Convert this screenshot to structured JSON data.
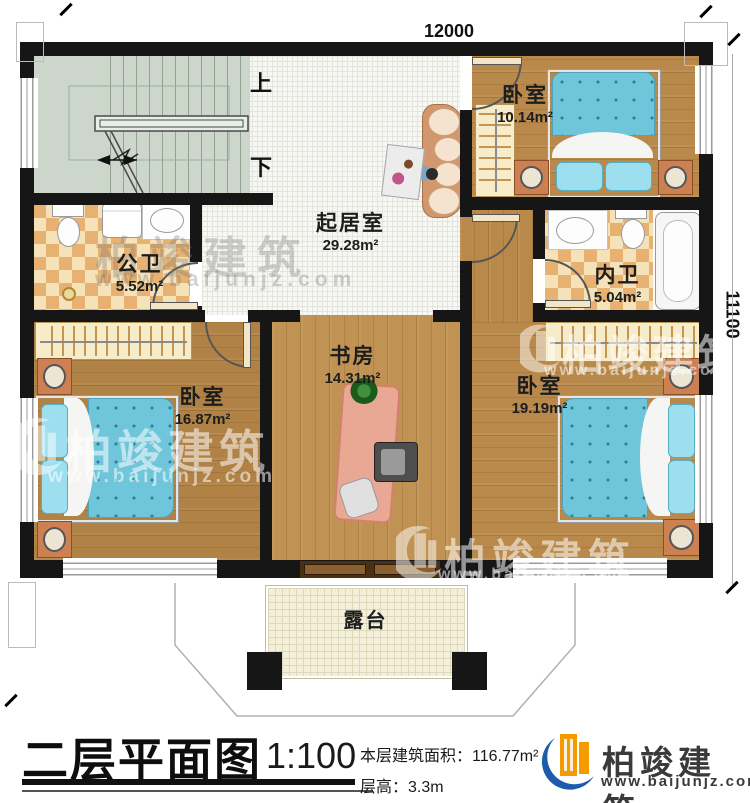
{
  "dimensions": {
    "top": "12000",
    "right": "11100"
  },
  "stairs": {
    "up": "上",
    "down": "下"
  },
  "rooms": {
    "bedroom_top": {
      "name": "卧室",
      "area": "10.14m²"
    },
    "living": {
      "name": "起居室",
      "area": "29.28m²"
    },
    "public_bath": {
      "name": "公卫",
      "area": "5.52m²"
    },
    "inner_bath": {
      "name": "内卫",
      "area": "5.04m²"
    },
    "bedroom_left": {
      "name": "卧室",
      "area": "16.87m²"
    },
    "study": {
      "name": "书房",
      "area": "14.31m²"
    },
    "bedroom_right": {
      "name": "卧室",
      "area": "19.19m²"
    },
    "terrace": {
      "name": "露台"
    }
  },
  "title_block": {
    "title": "二层平面图",
    "scale": "1:100",
    "area_label": "本层建筑面积：",
    "area_value": "116.77m²",
    "floor_height_label": "层高：",
    "floor_height_value": "3.3m"
  },
  "branding": {
    "logo_text": "柏竣建筑",
    "logo_url": "www.baijunjz.com",
    "watermark_text": "柏竣建筑",
    "watermark_url": "www.baijunjz.com",
    "colors": {
      "logo_blue": "#1d5cab",
      "logo_orange": "#f59b00",
      "wall": "#161616"
    }
  }
}
